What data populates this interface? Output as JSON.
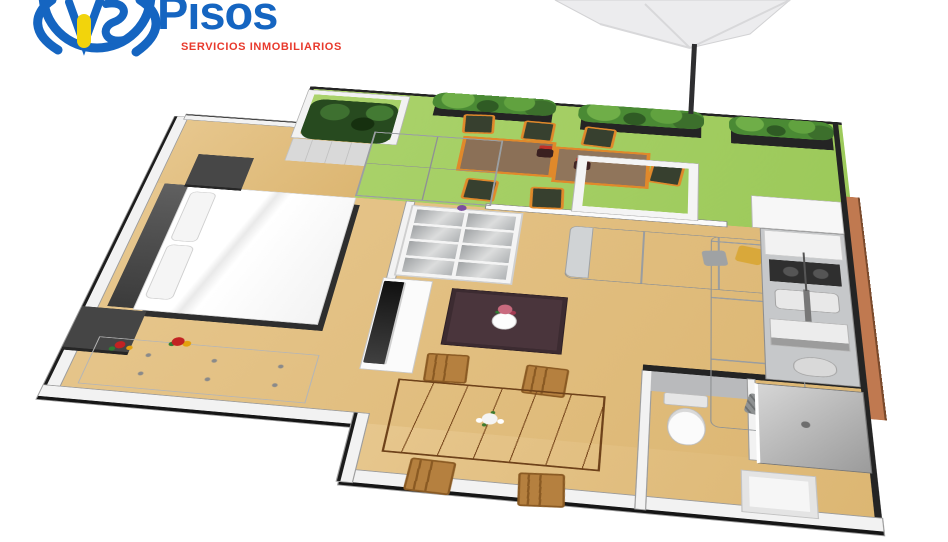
{
  "logo": {
    "monogram": "VS",
    "brand": "Pisos",
    "tagline": "SERVICIOS INMOBILIARIOS",
    "brand_color": "#1565c1",
    "tagline_color": "#e8392c",
    "door_color": "#f2d40c"
  },
  "floorplan": {
    "view": "3d-isometric-render",
    "colors": {
      "lawn": "#a4cf63",
      "wood_floor": "#e2bf82",
      "walls": "#f2f2f2",
      "sofa": "#b5b8ba",
      "dining_wood": "#a8703a",
      "outdoor_frame": "#e0892b",
      "brick_wall": "#c07950",
      "dark_furniture": "#3f3f3f",
      "shower_tile": "#aeaeae"
    },
    "rooms": [
      {
        "name": "terrace",
        "floor": "lawn",
        "items": [
          "hedge-planter",
          "hedge-planter",
          "hedge-planter",
          "corner-plant",
          "glass-panel-frame",
          "outdoor-table",
          "outdoor-table",
          "outdoor-chair",
          "outdoor-chair",
          "outdoor-chair",
          "outdoor-chair",
          "outdoor-chair",
          "outdoor-chair",
          "flower-pot",
          "flower-pot",
          "parasol"
        ]
      },
      {
        "name": "bedroom",
        "floor": "wood",
        "items": [
          "double-bed",
          "headboard-panel",
          "nightstand",
          "nightstand",
          "mirrored-wardrobe",
          "dresser",
          "flower-pot"
        ]
      },
      {
        "name": "living-room",
        "floor": "wood",
        "items": [
          "shelving-unit",
          "tv",
          "tv-stand",
          "coffee-table",
          "vase-with-flowers",
          "l-shaped-sofa",
          "cushion-yellow",
          "cushion-grey",
          "cushion-patterned",
          "glass-door-frame"
        ]
      },
      {
        "name": "dining-area",
        "floor": "wood",
        "items": [
          "dining-table",
          "dining-chair",
          "dining-chair",
          "dining-chair",
          "dining-chair",
          "flower-centerpiece"
        ]
      },
      {
        "name": "kitchen",
        "floor": "wood",
        "items": [
          "fridge",
          "cooktop",
          "sink",
          "faucet",
          "oven",
          "counter-run"
        ]
      },
      {
        "name": "bathroom",
        "floor": "wood",
        "items": [
          "toilet",
          "shower",
          "washbasin",
          "tiled-partition"
        ]
      }
    ]
  }
}
